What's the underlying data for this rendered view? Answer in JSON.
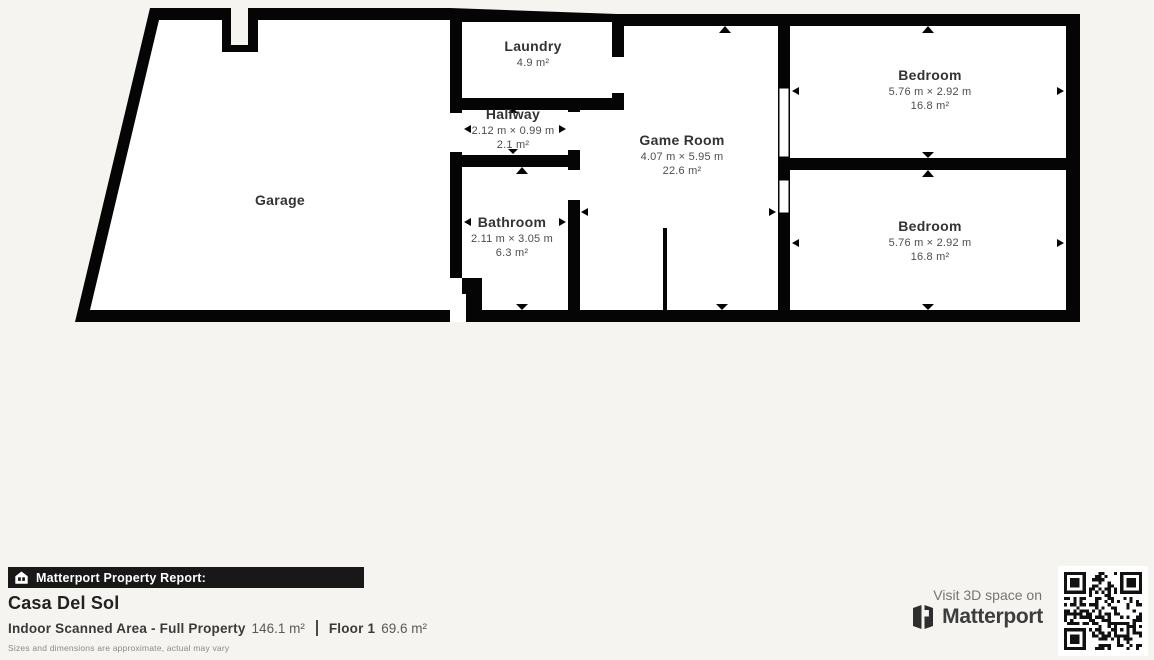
{
  "plan": {
    "rooms": {
      "garage": {
        "name": "Garage"
      },
      "laundry": {
        "name": "Laundry",
        "area": "4.9 m²"
      },
      "hallway": {
        "name": "Hallway",
        "dims": "2.12 m × 0.99 m",
        "area": "2.1 m²"
      },
      "bathroom": {
        "name": "Bathroom",
        "dims": "2.11 m × 3.05 m",
        "area": "6.3 m²"
      },
      "game_room": {
        "name": "Game Room",
        "dims": "4.07 m × 5.95 m",
        "area": "22.6 m²"
      },
      "bedroom_top": {
        "name": "Bedroom",
        "dims": "5.76 m × 2.92 m",
        "area": "16.8 m²"
      },
      "bedroom_bottom": {
        "name": "Bedroom",
        "dims": "5.76 m × 2.92 m",
        "area": "16.8 m²"
      }
    }
  },
  "footer": {
    "report_label": "Matterport Property Report:",
    "property_name": "Casa Del Sol",
    "scanned_area_label": "Indoor Scanned Area - Full Property",
    "scanned_area_value": "146.1 m²",
    "floor_label": "Floor 1",
    "floor_value": "69.6 m²",
    "disclaimer": "Sizes and dimensions are approximate, actual may vary",
    "visit_label": "Visit 3D space on",
    "brand": "Matterport"
  },
  "colors": {
    "background": "#f5f4f1",
    "wall": "#050505",
    "room_fill": "#ffffff",
    "bar_background": "#181818",
    "qr_dark": "#111111"
  }
}
